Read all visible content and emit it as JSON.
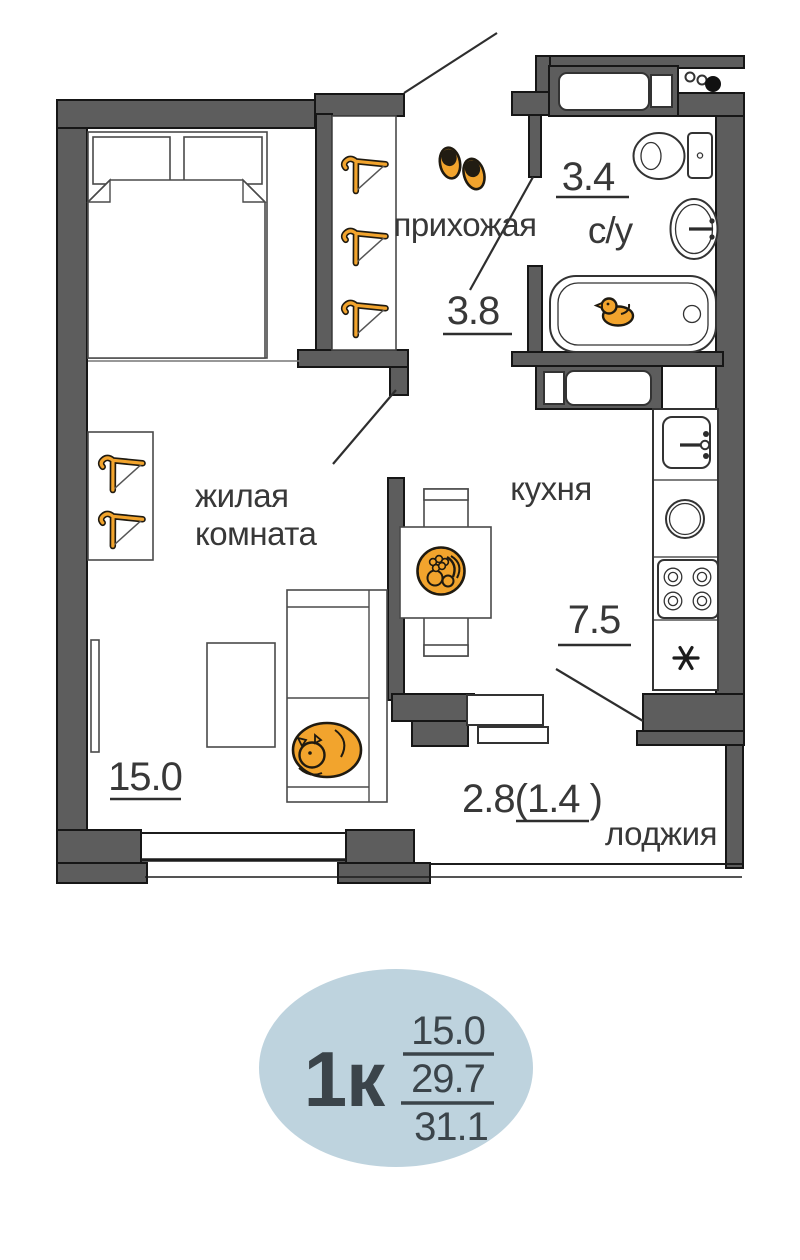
{
  "plan_labels": {
    "hallway_name": "прихожая",
    "hallway_area": "3.8",
    "bathroom_area": "3.4",
    "bathroom_name": "с/у",
    "kitchen_name": "кухня",
    "kitchen_area": "7.5",
    "living_name_line1": "жилая",
    "living_name_line2": "комната",
    "living_area": "15.0",
    "loggia_area": "2.8(1.4 )",
    "loggia_name": "лоджия"
  },
  "legend_badge": {
    "apartment_type": "1к",
    "living_area": "15.0",
    "area_without_loggia": "29.7",
    "total_area": "31.1"
  },
  "colors": {
    "wall": "#5d5d5d",
    "wall_outline": "#161616",
    "accent_orange": "#f2a42d",
    "badge_fill": "#bed3de",
    "text": "#383838"
  },
  "icons": {
    "hanger": "clothes-hanger",
    "slippers": "slippers",
    "rubber_duck": "rubber-duck",
    "cat": "sleeping-cat",
    "fruit_bowl": "fruit-bowl",
    "fridge_spot": "asterisk-fridge-position",
    "risers": "plumbing-risers"
  }
}
